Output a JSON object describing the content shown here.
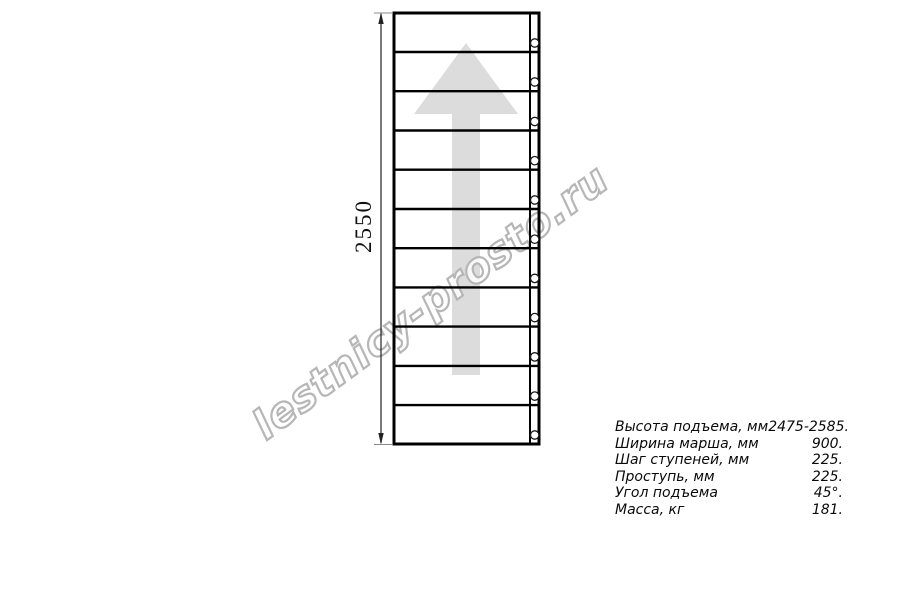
{
  "page": {
    "background": "#ffffff"
  },
  "colors": {
    "line": "#000000",
    "arrow_fill": "#dcdcdc",
    "watermark_outline": "#b6b6b6",
    "watermark_fill": "rgba(255,255,255,0.8)",
    "text": "#000000"
  },
  "drawing": {
    "steps_count": 11,
    "dimension": {
      "label": "2550"
    },
    "watermark": {
      "text": "lestnicy-prosto.ru"
    }
  },
  "specs": {
    "rows": [
      {
        "label": "Высота подъема, мм",
        "value": "2475-2585."
      },
      {
        "label": "Ширина марша, мм",
        "value": "900."
      },
      {
        "label": "Шаг ступеней, мм",
        "value": "225."
      },
      {
        "label": "Проступь, мм",
        "value": "225."
      },
      {
        "label": "Угол подъема",
        "value": "45°."
      },
      {
        "label": "Масса, кг",
        "value": "181."
      }
    ]
  }
}
